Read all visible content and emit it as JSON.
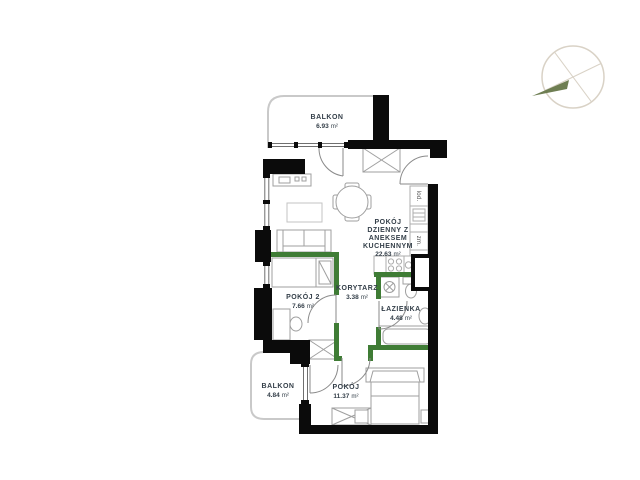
{
  "plan": {
    "rooms": [
      {
        "name": "BALKON",
        "area_value": "6.93",
        "area_unit": "m²"
      },
      {
        "name_lines": [
          "POKÓJ",
          "DZIENNY Z",
          "ANEKSEM",
          "KUCHENNYM"
        ],
        "area_value": "22.63",
        "area_unit": "m²"
      },
      {
        "name": "POKÓJ 2",
        "area_value": "7.66",
        "area_unit": "m²"
      },
      {
        "name": "KORYTARZ",
        "area_value": "3.38",
        "area_unit": "m²"
      },
      {
        "name": "ŁAZIENKA",
        "area_value": "4.48",
        "area_unit": "m²"
      },
      {
        "name": "BALKON",
        "area_value": "4.84",
        "area_unit": "m²"
      },
      {
        "name": "POKÓJ",
        "area_value": "11.37",
        "area_unit": "m²"
      }
    ],
    "kitchen": {
      "fridge_label": "lod.",
      "dishwasher_label": "zm."
    },
    "colors": {
      "wall_black": "#0b0b0b",
      "unit_highlight_green": "#3f7c35",
      "balcony_outline_gray": "#c9c9c9",
      "furniture_gray": "#9f9f9f",
      "label_text": "#343f49",
      "compass_needle_olive": "#6e7e52",
      "compass_ring_beige": "#d9d2c6"
    }
  }
}
